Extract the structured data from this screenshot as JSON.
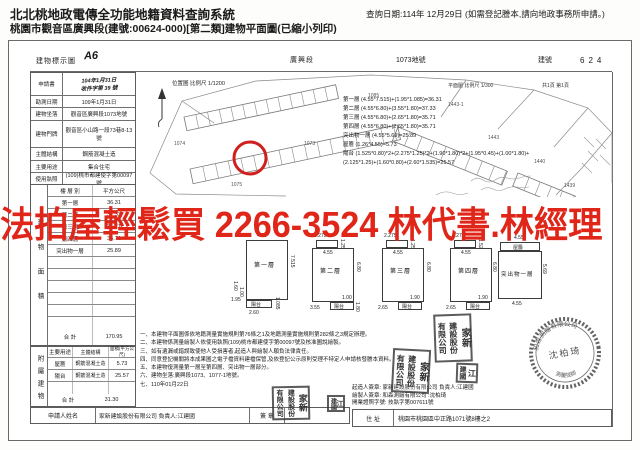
{
  "header": {
    "system_title": "北北桃地政電傳全功能地籍資料查詢系統",
    "doc_subtitle": "桃園市觀音區廣興段(建號:00624-000)[第二類]建物平面圖(已縮小列印)",
    "query_date": "查詢日期:114年 12月29日 (如需登記謄本,請向地政事務所申請。)"
  },
  "watermark": {
    "text": "法拍屋輕鬆買 2266-3524 林代書.林經理",
    "color": "#e02519"
  },
  "title_row": {
    "doc_type": "建物標示圖",
    "doc_mark": "A6",
    "section": "廣興段",
    "parcel": "1073地號",
    "building_no_label": "建號",
    "building_no": "624"
  },
  "scale_row": {
    "plan_scale": "平面圖 比例尺 1/300",
    "page_info": "共1頁 第1頁"
  },
  "info_fields": [
    {
      "label": "申請書",
      "value": "104年1月31日",
      "value2": "收件字第 39 號",
      "handwritten": true
    },
    {
      "label": "勘測日期",
      "value": "109年1月31日"
    },
    {
      "label": "建物坐落",
      "value": "觀音區廣興段1073地號"
    },
    {
      "label": "建物門牌",
      "value": "觀音區小山路一段73巷8-13號"
    },
    {
      "label": "主體結構",
      "value": "鋼筋混凝土造"
    },
    {
      "label": "主要用途",
      "value": "集合住宅"
    },
    {
      "label": "使用執照",
      "value": "(109)桃市都建使字第00097號"
    }
  ],
  "area_table": {
    "side_label": "建物面積",
    "col_floor": "樓 層 別",
    "col_area": "平方公尺",
    "rows": [
      {
        "floor": "第一層",
        "area": "36.31"
      },
      {
        "floor": "第二層",
        "area": "37.33"
      },
      {
        "floor": "第三層",
        "area": "35.71"
      },
      {
        "floor": "第四層",
        "area": "35.71"
      },
      {
        "floor": "突出物一層",
        "area": "25.89"
      },
      {
        "floor": "",
        "area": ""
      },
      {
        "floor": "",
        "area": ""
      },
      {
        "floor": "",
        "area": ""
      },
      {
        "floor": "",
        "area": ""
      },
      {
        "floor": "",
        "area": ""
      },
      {
        "floor": "",
        "area": ""
      }
    ],
    "total_label": "合  計",
    "total": "170.95"
  },
  "attached_table": {
    "side_label": "附屬建物",
    "col_use": "主要用途",
    "col_structure": "主體結構",
    "col_area": "面積(平方公尺)",
    "rows": [
      {
        "use": "屋簷",
        "structure": "鋼筋混凝土造",
        "area": "5.73"
      },
      {
        "use": "陽台",
        "structure": "鋼筋混凝土造",
        "area": "25.57"
      },
      {
        "use": "",
        "structure": "",
        "area": ""
      }
    ],
    "total_label": "合  計",
    "total": "31.30"
  },
  "applicant_row": {
    "label": "申請人姓名",
    "value": "家新建設股份有限公司 負責人:江建國",
    "sign_label": "簽 章"
  },
  "calculations": [
    "第一層 (4.55*7.515)+(1.95*1.085)=36.31",
    "第二層 (4.55*6.80)+(3.55*1.80)=37.33",
    "第三層 (4.55*6.80)+(2.65*1.80)=35.71",
    "第四層 (4.55*6.80)+(2.65*1.80)=35.71",
    "突出物一層 (4.55*5.69)=25.89",
    "屋簷 (1.26*4.55)=5.73",
    "陽台 (1.525*0.80)*2+(2.275*1.25)*2+(1.90*1.80)*2+(1.95*0.45)+(1.00*1.80)+",
    "(2.125*1.25)+(1.60*0.80)+(2.60*1.535)=25.57"
  ],
  "map": {
    "title": "位置圖 比例尺 1/1200",
    "highlight_color": "#cf201e",
    "labels": [
      {
        "t": "1074",
        "x": 38,
        "y": 72
      },
      {
        "t": "1075",
        "x": 95,
        "y": 113
      },
      {
        "t": "1073",
        "x": 168,
        "y": 72
      },
      {
        "t": "1085",
        "x": 232,
        "y": 24
      },
      {
        "t": "1443-1",
        "x": 312,
        "y": 33
      },
      {
        "t": "1443",
        "x": 352,
        "y": 66
      },
      {
        "t": "1440",
        "x": 398,
        "y": 90
      },
      {
        "t": "1439",
        "x": 428,
        "y": 114
      }
    ]
  },
  "plans": [
    {
      "name": "第一層",
      "w": "4.55",
      "h": "7.515",
      "balcony": "陽台",
      "d1": "1.95",
      "d2": "2.60",
      "d3": "1.085",
      "d4": "1.60",
      "d5": "1.00"
    },
    {
      "name": "第二層",
      "w": "4.55",
      "h": "6.80",
      "tb_w": "2.275",
      "tb_h": "1.25",
      "balcony": "陽台",
      "d1": "3.55",
      "d2": "1.00",
      "d3": "1.80"
    },
    {
      "name": "第三層",
      "w": "4.55",
      "h": "6.80",
      "tb_w": "2.275",
      "tb_h": "1.25",
      "balcony": "陽台",
      "d1": "2.65",
      "d2": "1.90"
    },
    {
      "name": "第四層",
      "w": "4.55",
      "h": "6.80",
      "tb_w": "2.275",
      "tb_h": "1.525",
      "balcony": "陽台",
      "d1": "2.65",
      "d2": "1.90"
    },
    {
      "name": "突出物一層",
      "w": "4.55",
      "h": "5.69",
      "roof": "屋簷",
      "roof_w": "4.55",
      "d1": "4.55"
    }
  ],
  "notes": [
    "一、本建物平面圖係依地籍測量實施規則第76條之1及地籍測量實施規則第282條之3規定辦理。",
    "二、本建物係測量繪製人依使用執照(109)桃市都建使字第00097號及核准圖說繪製。",
    "三、如有遺漏或錯誤致使他人受損害者,起造人與繪製人願負法律責任。",
    "四、同意登記機關將本成果圖之電子檔資料建檔保管,及依登記公示原則受理不特定人申請核發謄本資料。",
    "五、本建物復測量第一層至第四層、突出物一層部分。",
    "六、建物坐落:廣興段1073、1077-1地號。",
    "七、110年01月22日"
  ],
  "right_block": {
    "builder": "起造人簽章: 家新建設股份有限公司 負責人:江建國",
    "drafter": "繪製人簽章: 和森測繪有限公司 :沈柏琦",
    "license": "開業證照字號: 技執字第007611號",
    "address_label": "住 址",
    "address": "桃園市桃園區中正路1071號8樓之2"
  },
  "seals": {
    "company_c1": "家新",
    "company_c2": "建設股份",
    "company_c3": "有限公司",
    "person_c1": "江",
    "person_c2": "建國",
    "surveyor_firm": "和森測繪有限公司",
    "surveyor_name": "沈柏琦",
    "surveyor_title": "測量技師"
  }
}
